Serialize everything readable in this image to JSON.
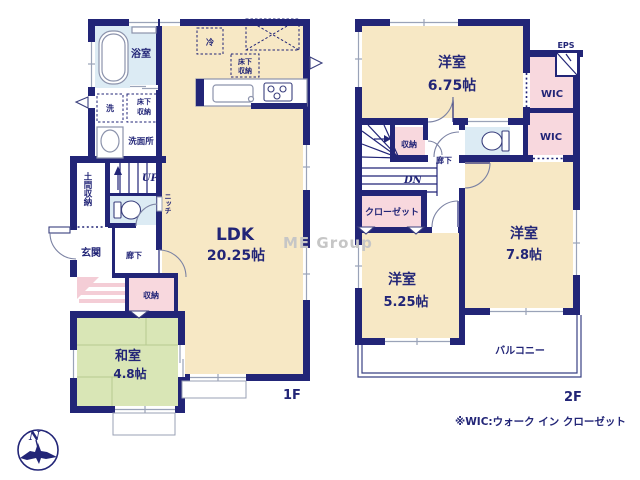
{
  "plan": {
    "f1": {
      "label": "1F",
      "ldk": "LDK",
      "ldk_size": "20.25帖",
      "washitsu": "和室",
      "washitsu_size": "4.8帖",
      "bath": "浴室",
      "washroom": "洗面所",
      "washer": "洗",
      "underfloor1": "床下",
      "underfloor2": "収納",
      "fridge": "冷",
      "doma": "土間収納",
      "genkan": "玄関",
      "hall": "廊下",
      "storage": "収納",
      "niche": "ニッチ",
      "up": "UP"
    },
    "f2": {
      "label": "2F",
      "room675": "洋室",
      "room675_size": "6.75帖",
      "room78": "洋室",
      "room78_size": "7.8帖",
      "room525": "洋室",
      "room525_size": "5.25帖",
      "wic": "WIC",
      "eps": "EPS",
      "storage": "収納",
      "hall": "廊下",
      "closet": "クローゼット",
      "balcony": "バルコニー",
      "dn": "DN"
    },
    "note": "※WIC:ウォーク イン クローゼット",
    "watermark": "ME Group",
    "compass": "N",
    "colors": {
      "wall_navy": "#222577",
      "room_cream": "#F7E8C5",
      "wet_area_blue": "#DCEBF4",
      "tatami_green": "#D9E6B6",
      "storage_pink": "#F8D8DE",
      "watermark_gray": "#C6C6C6"
    }
  }
}
